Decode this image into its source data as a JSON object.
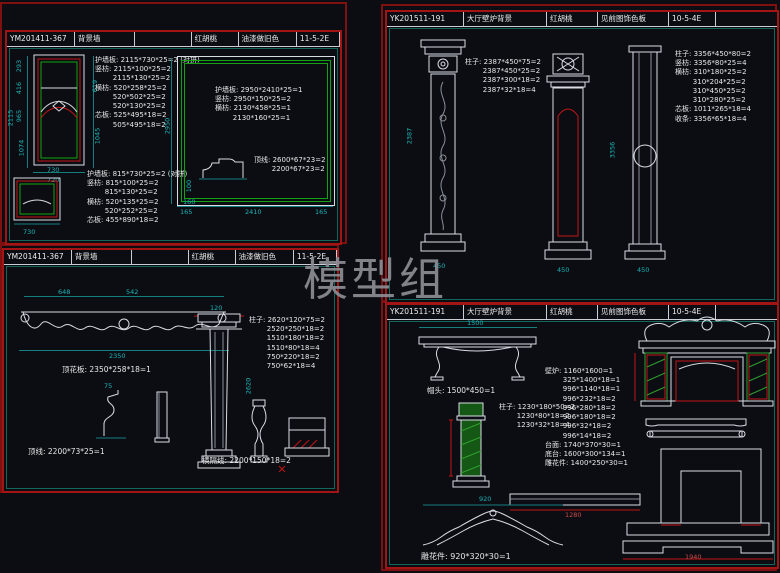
{
  "watermark": "模型组",
  "colors": {
    "background": "#0b0d13",
    "panel_border": "#a31414",
    "sheet_border": "#7e1010",
    "line_white": "#d9dde3",
    "accent_red": "#c31515",
    "accent_green": "#12a312",
    "dim_teal": "#1ab5b5",
    "dim_red": "#cf4a4a",
    "watermark_gray": "#8d8d94"
  },
  "panels": {
    "tl": {
      "title": [
        "YM201411-367",
        "背景墙",
        "",
        "红胡桃",
        "油漆做旧色",
        "11-5-2E"
      ],
      "blocks": {
        "b1": [
          "护墙板: 2115*730*25=2 (对拼)",
          "竖枋: 2115*100*25=2",
          "        2115*130*25=2",
          "横枋: 520*258*25=2",
          "        520*502*25=2",
          "        520*130*25=2",
          "芯板: 525*495*18=2",
          "        505*495*18=2"
        ],
        "b2": [
          "护墙板: 2950*2410*25=1",
          "竖枋: 2950*150*25=2",
          "横枋: 2130*458*25=1",
          "        2130*160*25=1"
        ],
        "b3": [
          "顶线: 2600*67*23=2",
          "        2200*67*23=2"
        ],
        "b4": [
          "护墙板: 815*730*25=2 (对拼)",
          "竖枋: 815*100*25=2",
          "        815*130*25=2",
          "横枋: 520*135*25=2",
          "        520*252*25=2",
          "芯板: 455*890*18=2"
        ]
      },
      "dims": {
        "h1": "293",
        "h2": "416",
        "h3": "965",
        "h4": "1074",
        "total": "2115",
        "r1": "619",
        "r2": "1045",
        "b1": "730",
        "b2": "720",
        "big_v": "2950",
        "bb1": "165",
        "bb2": "2410",
        "bb3": "165",
        "s1": "100",
        "s2": "160",
        "sp_b": "730"
      }
    },
    "tr": {
      "title": [
        "YK201511-191",
        "大厅壁炉背景",
        "红胡桃",
        "见前图饰色板",
        "10-5-4E"
      ],
      "blocks": {
        "left": [
          "柱子: 2387*450*75=2",
          "        2387*450*25=2",
          "        2387*300*18=2",
          "        2387*32*18=4"
        ],
        "right": [
          "柱子: 3356*450*80=2",
          "竖枋: 3356*80*25=4",
          "横枋: 310*180*25=2",
          "        310*204*25=2",
          "        310*450*25=2",
          "        310*280*25=2",
          "芯板: 1011*265*18=4",
          "收条: 3356*65*18=4"
        ]
      },
      "dims": {
        "c1": "2387",
        "c1b": "450",
        "c2": "3356",
        "c2b": "450",
        "c3b": "450"
      }
    },
    "bl": {
      "title": [
        "YM201411-367",
        "背景墙",
        "",
        "红胡桃",
        "油漆做旧色",
        "11-5-2E"
      ],
      "labels": {
        "top_board": "顶花板: 2350*258*18=1",
        "molding": "顶线: 2200*73*25=1",
        "divider": "横隔线: 2200*150*18=2"
      },
      "blocks": {
        "pillar": [
          "柱子: 2620*120*75=2",
          "        2520*250*18=2",
          "        1510*180*18=2",
          "        1510*80*18=4",
          "        750*220*18=2",
          "        750*62*18=4"
        ]
      },
      "dims": {
        "t1": "648",
        "t2": "542",
        "beam": "2350",
        "prof": "75",
        "colw": "120",
        "colh": "2620"
      }
    },
    "br": {
      "title": [
        "YK201511-191",
        "大厅壁炉背景",
        "红胡桃",
        "见前图饰色板",
        "10-5-4E"
      ],
      "labels": {
        "cap": "帽头: 1500*450=1",
        "carving": "雕花件: 920*320*30=1"
      },
      "blocks": {
        "pillar": [
          "柱子: 1230*180*50=2",
          "        1230*80*18=2",
          "        1230*32*18=4"
        ],
        "fireplace": [
          "壁炉: 1160*1600=1",
          "        325*1400*18=1",
          "        996*1140*18=1",
          "        996*232*18=2",
          "        996*280*18=2",
          "        996*180*18=2",
          "        996*32*18=2",
          "        996*14*18=2",
          "台面: 1740*370*30=1",
          "底台: 1600*300*134=1",
          "雕花件: 1400*250*30=1"
        ]
      },
      "dims": {
        "bench": "1500",
        "arch": "920",
        "bar": "1280",
        "base": "1940"
      }
    }
  }
}
